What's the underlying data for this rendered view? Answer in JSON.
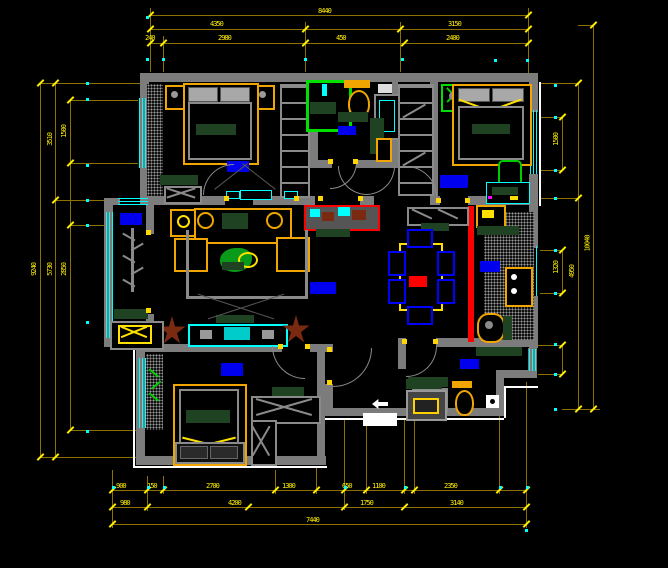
{
  "drawing": {
    "type": "cad-floor-plan",
    "background": "#000000",
    "colors": {
      "wall": "#7c7c7c",
      "dim_line": "#8c7000",
      "dim_text": "#ffee00",
      "window": "#00ffff",
      "rug": "#0000ee",
      "furniture_accent": "#f0a500",
      "bedding_green": "#1e4222",
      "fixture_green": "#00e000",
      "partition_red": "#ff0000",
      "plant_brown": "#7a2a10"
    }
  },
  "dims": {
    "t1": [
      {
        "t": "8440"
      }
    ],
    "t2": [
      {
        "t": "4350"
      },
      {
        "t": "3150"
      }
    ],
    "t3": [
      {
        "t": "240"
      },
      {
        "t": "2980"
      },
      {
        "t": "450"
      },
      {
        "t": "2400"
      }
    ],
    "bA": [
      {
        "t": "900"
      },
      {
        "t": "150"
      },
      {
        "t": "2700"
      },
      {
        "t": "1300"
      },
      {
        "t": "650"
      },
      {
        "t": "1100"
      },
      {
        "t": "2350"
      }
    ],
    "bB": [
      {
        "t": "980"
      },
      {
        "t": "4200"
      },
      {
        "t": "1750"
      },
      {
        "t": "3140"
      }
    ],
    "bC": [
      {
        "t": "7440"
      }
    ],
    "l": [
      {
        "t": "1500"
      },
      {
        "t": "3510"
      },
      {
        "t": "9240"
      },
      {
        "t": "5730"
      },
      {
        "t": "2850"
      }
    ],
    "r": [
      {
        "t": "1500"
      },
      {
        "t": "1320"
      },
      {
        "t": "4950"
      },
      {
        "t": "10040"
      }
    ]
  }
}
